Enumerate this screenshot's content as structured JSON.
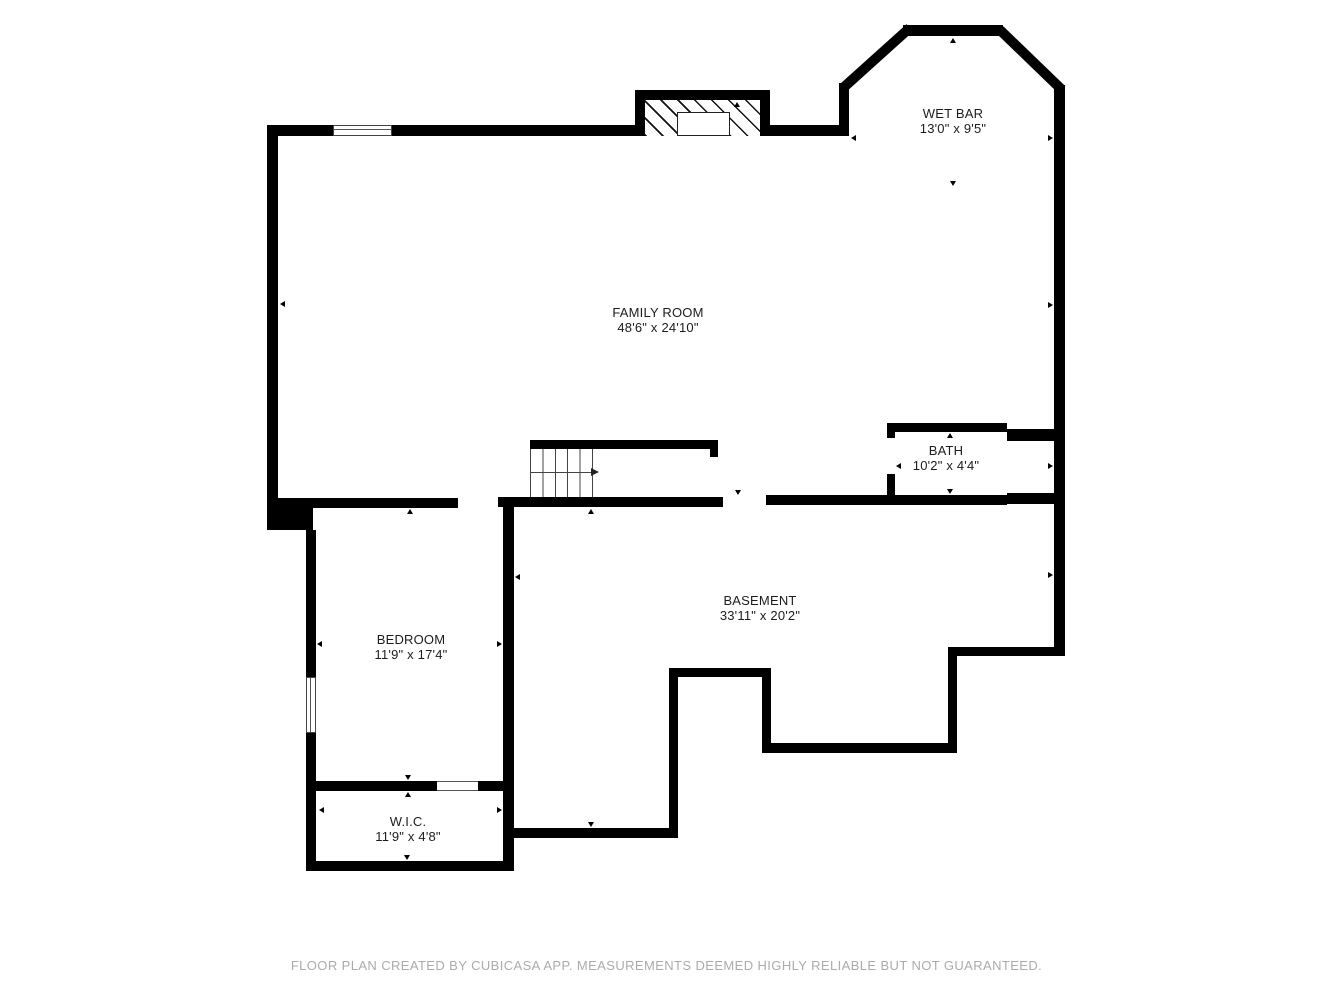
{
  "rooms": {
    "family_room": {
      "name": "FAMILY ROOM",
      "dims": "48'6\" x 24'10\""
    },
    "wet_bar": {
      "name": "WET BAR",
      "dims": "13'0\" x 9'5\""
    },
    "bath": {
      "name": "BATH",
      "dims": "10'2\" x 4'4\""
    },
    "basement": {
      "name": "BASEMENT",
      "dims": "33'11\" x 20'2\""
    },
    "bedroom": {
      "name": "BEDROOM",
      "dims": "11'9\" x 17'4\""
    },
    "wic": {
      "name": "W.I.C.",
      "dims": "11'9\" x 4'8\""
    }
  },
  "footer": {
    "disclaimer": "FLOOR PLAN CREATED BY CUBICASA APP. MEASUREMENTS DEEMED HIGHLY RELIABLE BUT NOT GUARANTEED."
  },
  "colors": {
    "wall": "#000000",
    "label_text": "#1c1c1c",
    "footer_text": "#ababab",
    "background": "#ffffff"
  }
}
